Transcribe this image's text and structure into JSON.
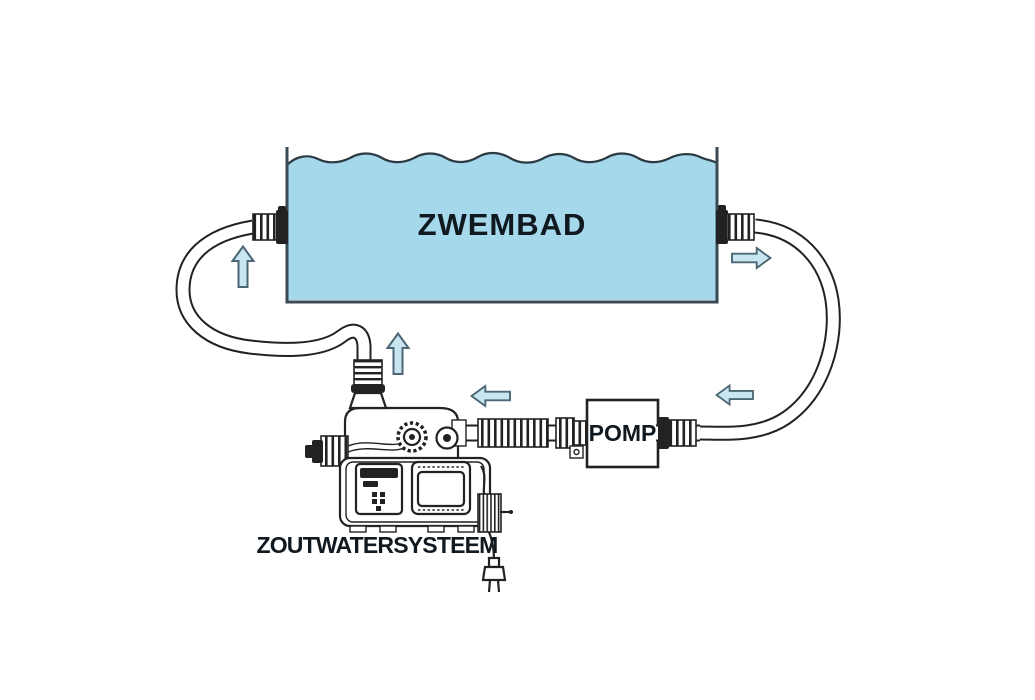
{
  "labels": {
    "pool": "ZWEMBAD",
    "pump": "POMP",
    "saltwater_system": "ZOUTWATERSYSTEEM"
  },
  "colors": {
    "pool_fill": "#a4d8ea",
    "pool_stroke": "#3a4a54",
    "water_line": "#2c3a44",
    "line": "#222222",
    "arrow_fill": "#c8e6f1",
    "arrow_stroke": "#4c6673",
    "label_color": "#101820",
    "background": "#ffffff"
  },
  "flow_arrows": [
    {
      "icon": "up-arrow-icon",
      "direction": "up",
      "location": "left-return-hose"
    },
    {
      "icon": "up-arrow-icon",
      "direction": "up",
      "location": "system-inlet-to-pool"
    },
    {
      "icon": "right-arrow-icon",
      "direction": "right",
      "location": "pool-outlet-right"
    },
    {
      "icon": "left-arrow-icon",
      "direction": "left",
      "location": "suction-hose-right"
    },
    {
      "icon": "left-arrow-icon",
      "direction": "left",
      "location": "pump-to-system-hose"
    }
  ]
}
